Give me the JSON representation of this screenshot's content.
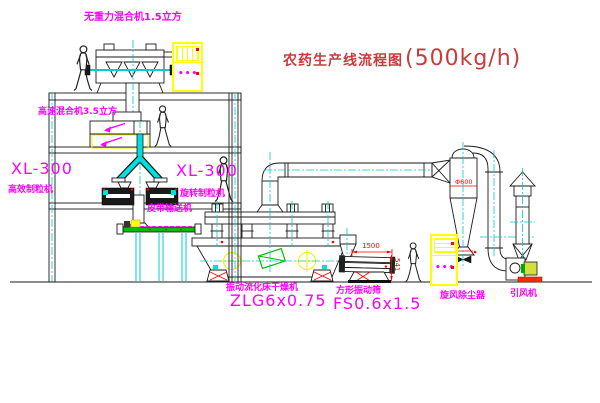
{
  "title": {
    "name": "农药生产线流程图",
    "capacity": "(500kg/h)"
  },
  "labels": {
    "gravity_mixer": "无重力混合机1.5立方",
    "high_speed_mixer": "高速混合机3.5立方",
    "granulator_left_model": "XL-300",
    "granulator_left_name": "高效制粒机",
    "granulator_right_model": "XL-300",
    "granulator_right_name": "旋转制粒机",
    "belt_conveyor": "皮带输送机",
    "dryer_name": "振动流化床干燥机",
    "dryer_model": "ZLG6x0.75",
    "screen_name": "方形振动筛",
    "screen_model": "FS0.6x1.5",
    "cyclone": "旋风除尘器",
    "fan": "引风机"
  },
  "dims": {
    "screen_length": "1500",
    "screen_height": "541",
    "cyclone_dia": "Φ600"
  },
  "indicators": {
    "cabinet_dots": "•••"
  },
  "colors": {
    "label_magenta": "#FF00FF",
    "title_red": "#C83C3C",
    "dimension_red": "#FF0000",
    "pipe_cyan": "#00CCCC",
    "cabinet_yellow": "#FFFF00",
    "belt_green": "#00C000",
    "line_black": "#1a1a1a"
  }
}
